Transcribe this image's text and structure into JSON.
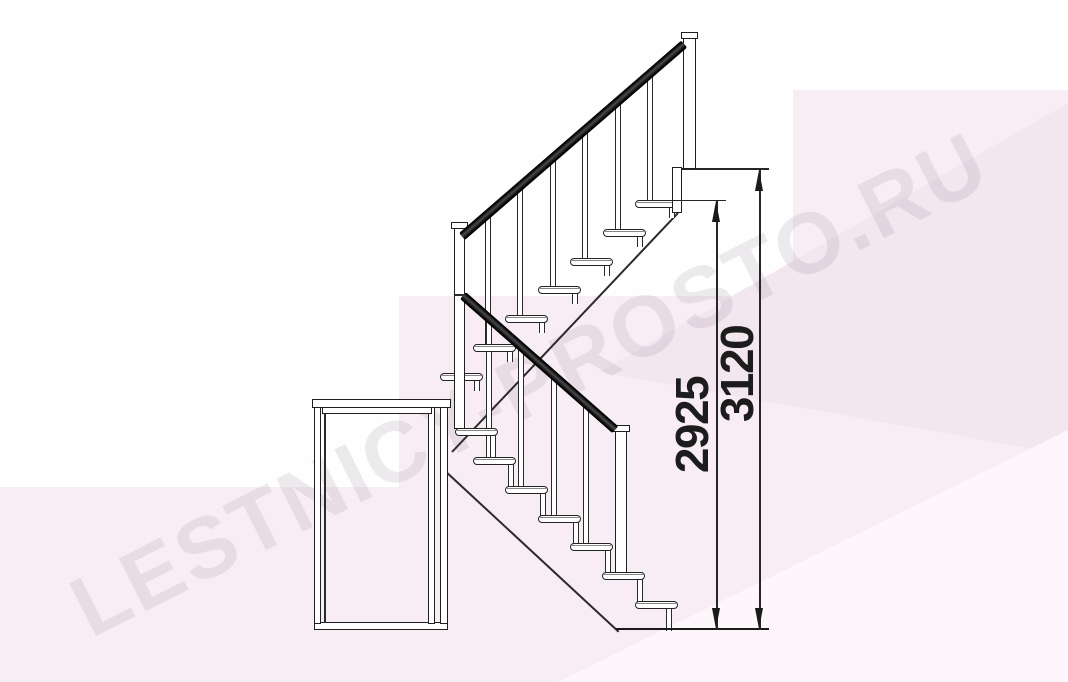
{
  "diagram": {
    "kind": "staircase side elevation drawing",
    "watermark": {
      "text": "LESTNICY-PROSTO.RU"
    },
    "dimensions": {
      "inner": {
        "label": "2925"
      },
      "outer": {
        "label": "3120"
      }
    },
    "structure": {
      "lower_flight_treads": 7,
      "upper_flight_treads": 7,
      "upper_balusters": 6,
      "lower_balusters": 4,
      "posts": 3
    },
    "colors": {
      "background": "#fefefe",
      "pink_panel": "#f8edf4",
      "pink_panel_dark": "#f3e7ef",
      "pink_panel_light": "#fdf6fa",
      "line": "#232323",
      "handrail": "#111111",
      "dimension_text": "#1c1c1c",
      "watermark_text": "rgba(90,62,90,0.105)"
    }
  }
}
